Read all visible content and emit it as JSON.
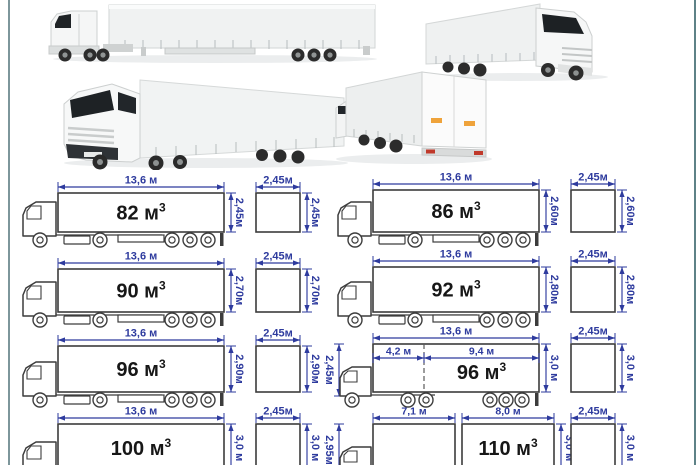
{
  "colors": {
    "dim": "#2e3b9e",
    "line": "#3c3c3c",
    "volume_text": "#171717",
    "dash": "#5a5a5a",
    "frame_left": "#7d969b",
    "frame_right": "#5e8287",
    "background": "#ffffff"
  },
  "photos": [
    {
      "name": "semi-truck-side-view-photo"
    },
    {
      "name": "semi-truck-front-quarter-right-photo"
    },
    {
      "name": "semi-truck-front-quarter-left-photo"
    },
    {
      "name": "semi-truck-rear-quarter-photo"
    }
  ],
  "rows": [
    {
      "truck_left": {
        "type": "semitrailer",
        "length_label": "13,6 м",
        "height_label": "2,45м",
        "height_m": 2.45,
        "volume": {
          "value": "82",
          "unit": "м",
          "exp": "3"
        }
      },
      "section_left": {
        "width_label": "2,45м",
        "height_label": "2,45м",
        "height_m": 2.45
      },
      "truck_right": {
        "type": "semitrailer",
        "length_label": "13,6 м",
        "height_label": "2,60м",
        "height_m": 2.6,
        "volume": {
          "value": "86",
          "unit": "м",
          "exp": "3"
        }
      },
      "section_right": {
        "width_label": "2,45м",
        "height_label": "2,60м",
        "height_m": 2.6
      }
    },
    {
      "truck_left": {
        "type": "semitrailer",
        "length_label": "13,6 м",
        "height_label": "2,70м",
        "height_m": 2.7,
        "volume": {
          "value": "90",
          "unit": "м",
          "exp": "3"
        }
      },
      "section_left": {
        "width_label": "2,45м",
        "height_label": "2,70м",
        "height_m": 2.7
      },
      "truck_right": {
        "type": "semitrailer",
        "length_label": "13,6 м",
        "height_label": "2,80м",
        "height_m": 2.8,
        "volume": {
          "value": "92",
          "unit": "м",
          "exp": "3"
        }
      },
      "section_right": {
        "width_label": "2,45м",
        "height_label": "2,80м",
        "height_m": 2.8
      }
    },
    {
      "truck_left": {
        "type": "semitrailer",
        "length_label": "13,6 м",
        "height_label": "2,90м",
        "height_m": 2.9,
        "volume": {
          "value": "96",
          "unit": "м",
          "exp": "3"
        }
      },
      "section_left": {
        "width_label": "2,45м",
        "height_label": "2,90м",
        "height_m": 2.9
      },
      "truck_right": {
        "type": "roadtrain_split",
        "length_label": "13,6 м",
        "segment_labels": [
          "4,2 м",
          "9,4 м"
        ],
        "segment_m": [
          4.2,
          9.4
        ],
        "front_height_label": "2,45м",
        "height_label": "3,0 м",
        "height_m": 3.0,
        "volume": {
          "value": "96",
          "unit": "м",
          "exp": "3"
        }
      },
      "section_right": {
        "width_label": "2,45м",
        "height_label": "3,0 м",
        "height_m": 3.0
      }
    },
    {
      "truck_left": {
        "type": "semitrailer",
        "length_label": "13,6 м",
        "height_label": "3,0 м",
        "height_m": 3.0,
        "volume": {
          "value": "100",
          "unit": "м",
          "exp": "3"
        }
      },
      "section_left": {
        "width_label": "2,45м",
        "height_label": "3,0 м",
        "height_m": 3.0
      },
      "truck_right": {
        "type": "roadtrain_two",
        "segment_labels": [
          "7,1 м",
          "8,0 м"
        ],
        "segment_m": [
          7.1,
          8.0
        ],
        "front_height_label": "2,95м",
        "height_label": "3,0 м",
        "height_m": 3.0,
        "volume": {
          "value": "110",
          "unit": "м",
          "exp": "3"
        }
      },
      "section_right": {
        "width_label": "2,45м",
        "height_label": "3,0 м",
        "height_m": 3.0
      }
    }
  ]
}
